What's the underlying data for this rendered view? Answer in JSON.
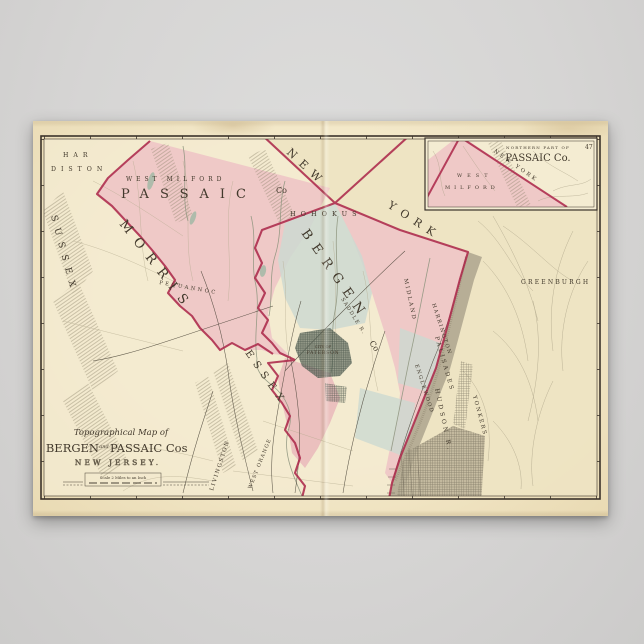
{
  "poster": {
    "cartouche": {
      "prefix": "Topographical Map of",
      "county1": "BERGEN",
      "conjunction": "and",
      "county2": "PASSAIC Cos",
      "state": "NEW JERSEY.",
      "scale_text": "Scale 2 Miles to an Inch"
    },
    "inset": {
      "heading_small": "NORTHERN PART OF",
      "heading_large": "PASSAIC Co.",
      "west": "WEST",
      "milford": "MILFORD",
      "new_york": "NEW YORK",
      "page_number": "47"
    },
    "labels": {
      "hardiston_line1": "HAR",
      "hardiston_line2": "DISTON",
      "sussex": "SUSSEX",
      "west_milford": "WEST MILFORD",
      "passaic": "PASSAIC",
      "passaic_suffix": "Co",
      "morris": "MORRIS",
      "pequannoc": "PEQUANNOC",
      "essex": "ESSEX",
      "new": "NEW",
      "york": "YORK",
      "hohokus": "HOHOKUS",
      "bergen": "BERGEN",
      "bergen_suffix": "Co",
      "midland": "MIDLAND",
      "saddle_river": "SADDLE R.",
      "greenburgh": "GREENBURGH",
      "harrington": "HARRINGTON",
      "englewood": "ENGLEWOOD",
      "palisades": "PALISADES",
      "city_of": "CITY OF",
      "paterson": "PATERSON",
      "hudson_river": "HUDSON R.",
      "yonkers": "YONKERS",
      "livingston": "LIVINGSTON",
      "west_orange": "WEST ORANGE"
    }
  },
  "colors": {
    "wall": "#d6d5d4",
    "paper": "#f1e5c4",
    "map_paper": "#f4ecd2",
    "ny_paper": "#ece1bf",
    "pink": "#eec5c5",
    "pink_deep": "#e9b8bb",
    "blue": "#ccd9d1",
    "boundary": "#ad2a4c",
    "river": "#b3ab94",
    "frame": "#3b332a",
    "ink": "#4a4236",
    "city": "#5f6e62"
  }
}
